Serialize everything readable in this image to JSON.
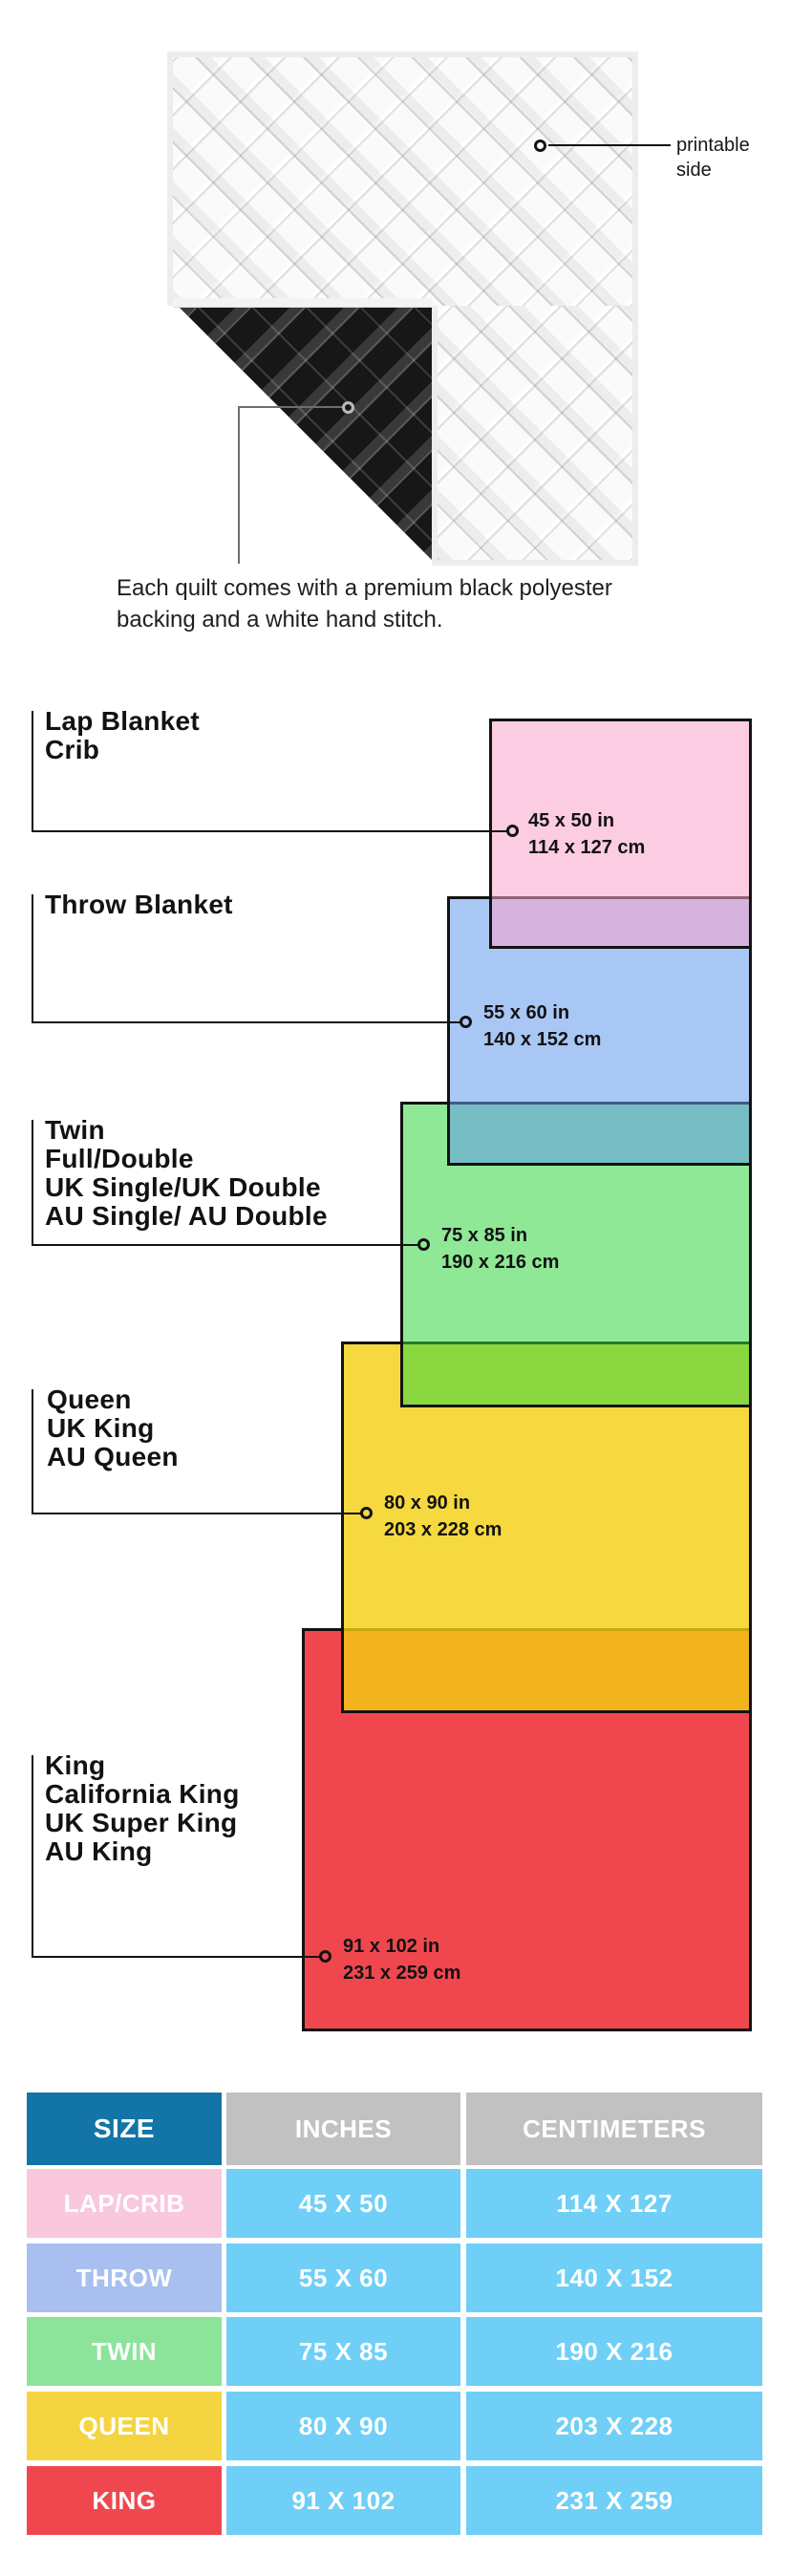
{
  "quilt": {
    "printable_label": [
      "printable",
      "side"
    ],
    "caption": [
      "Each quilt comes with a premium black polyester",
      "backing and a white hand stitch."
    ]
  },
  "diagram": {
    "items": [
      {
        "labels": [
          "Lap Blanket",
          "Crib"
        ],
        "inches": "45 x 50 in",
        "cm": "114 x 127 cm",
        "color": "#FACDE2"
      },
      {
        "labels": [
          "Throw Blanket"
        ],
        "inches": "55 x 60 in",
        "cm": "140 x 152 cm",
        "color": "#A9C7F4"
      },
      {
        "labels": [
          "Twin",
          "Full/Double",
          "UK Single/UK Double",
          "AU Single/ AU Double"
        ],
        "inches": "75 x 85 in",
        "cm": "190 x 216 cm",
        "color": "#8FE896"
      },
      {
        "labels": [
          "Queen",
          "UK King",
          "AU Queen"
        ],
        "inches": "80 x 90 in",
        "cm": "203 x 228 cm",
        "color": "#F5D93F"
      },
      {
        "labels": [
          "King",
          "California King",
          "UK Super King",
          "AU King"
        ],
        "inches": "91 x 102 in",
        "cm": "231 x 259 cm",
        "color": "#F0474F"
      }
    ]
  },
  "table": {
    "headers": [
      "SIZE",
      "INCHES",
      "CENTIMETERS"
    ],
    "rows": [
      {
        "size": "LAP/CRIB",
        "inches": "45 X 50",
        "centimeters": "114 X 127",
        "color": "#F9C8DC"
      },
      {
        "size": "THROW",
        "inches": "55 X 60",
        "centimeters": "140 X 152",
        "color": "#A8BFF0"
      },
      {
        "size": "TWIN",
        "inches": "75 X 85",
        "centimeters": "190 X 216",
        "color": "#8BE49A"
      },
      {
        "size": "QUEEN",
        "inches": "80 X 90",
        "centimeters": "203 X 228",
        "color": "#F5D441"
      },
      {
        "size": "KING",
        "inches": "91 X 102",
        "centimeters": "231 X 259",
        "color": "#F0474F"
      }
    ],
    "value_cell_color": "#6FCFF7",
    "header_size_color": "#1374A8",
    "header_metric_color": "#C1C1C1"
  }
}
